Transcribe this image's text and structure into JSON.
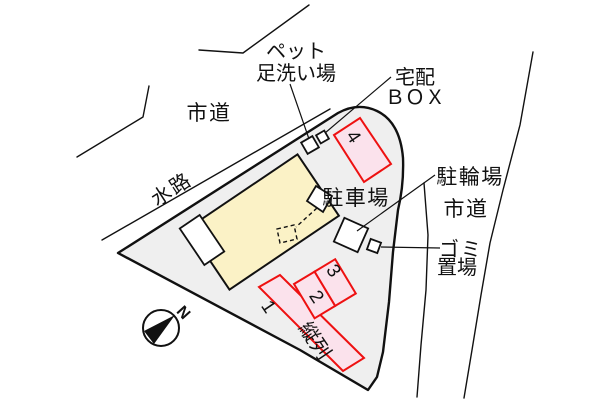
{
  "plan": {
    "type": "residential site plan",
    "labels": {
      "road_top": "市道",
      "road_right": "市道",
      "waterway": "水路",
      "pet_wash_line1": "ペット",
      "pet_wash_line2": "足洗い場",
      "delivery_line1": "宅配",
      "delivery_line2": "ＢＯＸ",
      "parking_lot": "駐車場",
      "bicycle_parking": "駐輪場",
      "garbage_line1": "ゴミ",
      "garbage_line2": "置場",
      "tandem": "縦列",
      "north": "N"
    },
    "parking_spaces": [
      "1",
      "2",
      "3",
      "4"
    ],
    "colors": {
      "site_fill": "#efefef",
      "building_fill": "#fbf2c6",
      "space_fill": "#fbe2ec",
      "space_border": "#ee1111",
      "line": "#111111"
    }
  }
}
